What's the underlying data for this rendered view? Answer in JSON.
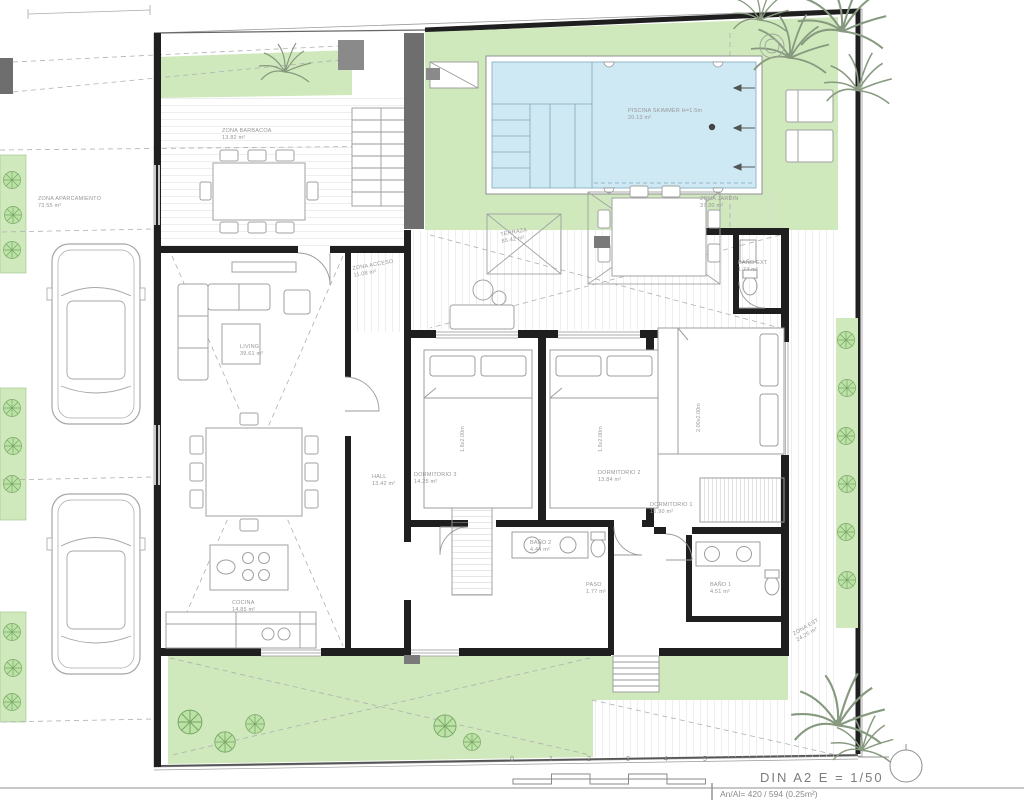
{
  "title_block": {
    "format_scale": "DIN A2  E = 1/50",
    "paper_info": "An/Al= 420 / 594 (0.25m²)"
  },
  "scale_bar": {
    "ticks": [
      "0",
      "1",
      "2",
      "3",
      "4",
      "5"
    ]
  },
  "pool": {
    "label": "PISCINA SKIMMER H=1.5m",
    "area": "20.13 m²"
  },
  "rooms": {
    "parking": {
      "name": "ZONA APARCAMIENTO",
      "area": "73.55 m²"
    },
    "barbacoa": {
      "name": "ZONA BARBACOA",
      "area": "13.82 m²"
    },
    "jardin": {
      "name": "ZONA JARDIN",
      "area": "37.30 m²"
    },
    "acceso": {
      "name": "ZONA ACCESO",
      "area": "11.08 m²"
    },
    "terraza": {
      "name": "TERRAZA",
      "area": "85.42 m²"
    },
    "living": {
      "name": "LIVING",
      "area": "39.61 m²"
    },
    "hall": {
      "name": "HALL",
      "area": "13.42 m²"
    },
    "dormitorio3": {
      "name": "DORMITORIO 3",
      "area": "14.25 m²"
    },
    "dormitorio2": {
      "name": "DORMITORIO 2",
      "area": "13.84 m²"
    },
    "dormitorio1": {
      "name": "DORMITORIO 1",
      "area": "15.90 m²"
    },
    "bano2": {
      "name": "BAÑO 2",
      "area": "4.44 m²"
    },
    "paso": {
      "name": "PASO",
      "area": "1.77 m²"
    },
    "bano1": {
      "name": "BAÑO 1",
      "area": "4.51 m²"
    },
    "cocina": {
      "name": "COCINA",
      "area": "14.85 m²"
    },
    "bano_ext": {
      "name": "BAÑO EXT",
      "area": "1.74 m²"
    },
    "zona_est": {
      "name": "ZONA EST",
      "area": "24.25 m²"
    }
  },
  "beds": {
    "dorm3": "1.8x2.00m",
    "dorm2": "1.8x2.00m",
    "dorm1": "2.00x2.00m"
  },
  "colors": {
    "garden_green": "#cfe8bc",
    "pool_water": "#cfe9f4",
    "wall_black": "#1f1f1f",
    "line_gray": "#b5b5b5",
    "label_gray": "#979797"
  }
}
